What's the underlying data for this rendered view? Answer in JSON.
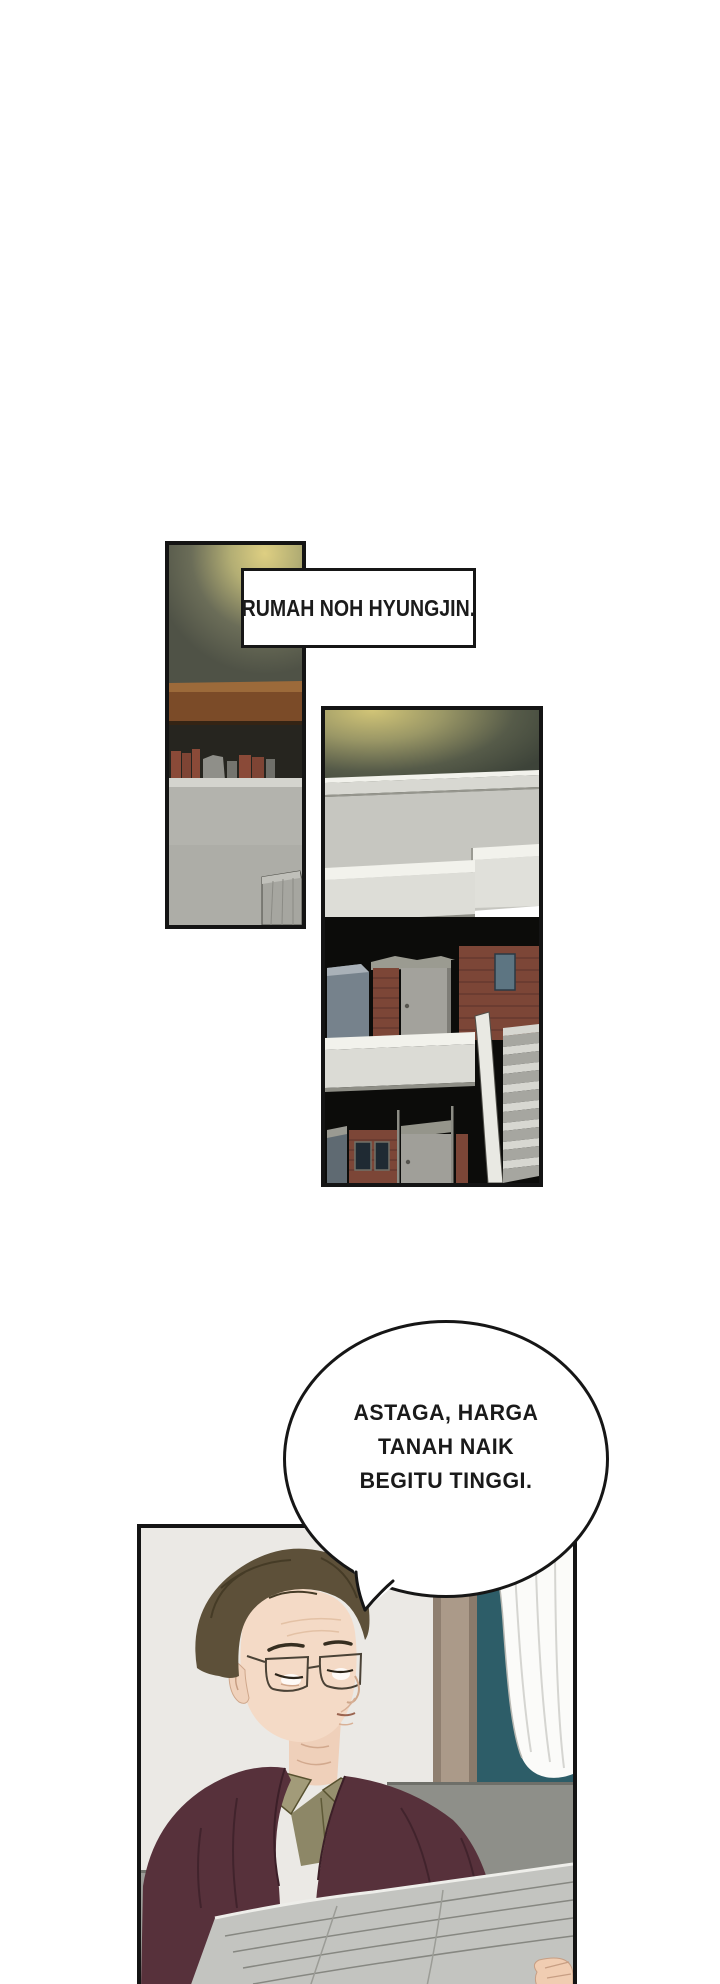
{
  "caption": {
    "text": "RUMAH NOH HYUNGJIN."
  },
  "speech_bubble": {
    "lines": [
      "ASTAGA, HARGA",
      "TANAH NAIK",
      "BEGITU TINGGI."
    ]
  },
  "panels": [
    {
      "id": "panel-1",
      "alt": "dim interior wall with lamp glow, wooden shelf with books and gray counter"
    },
    {
      "id": "panel-2",
      "alt": "night exterior of a two-story brick house with white balconies and outdoor staircase"
    },
    {
      "id": "panel-3",
      "alt": "older man with glasses in a maroon robe reading a newspaper on a sofa beside a teal window with white curtain"
    }
  ],
  "colors": {
    "page_background": "#ffffff",
    "ink": "#141414",
    "lamp_glow": "#decf82",
    "wall_olive": "#4f5246",
    "shelf_brown": "#7b4b28",
    "counter_gray": "#b3b3ad",
    "night_black": "#0c0c0a",
    "brick_red": "#7c4637",
    "concrete_white": "#f2f2ec",
    "window_teal": "#2d5d68",
    "curtain_white": "#fbfbf9",
    "sofa_gray": "#8e8f89",
    "robe_maroon": "#57313b",
    "shirt_olive": "#8d8767",
    "skin": "#f4dac6",
    "hair_brown": "#5d5039",
    "newspaper_gray": "#c3c4c0"
  }
}
